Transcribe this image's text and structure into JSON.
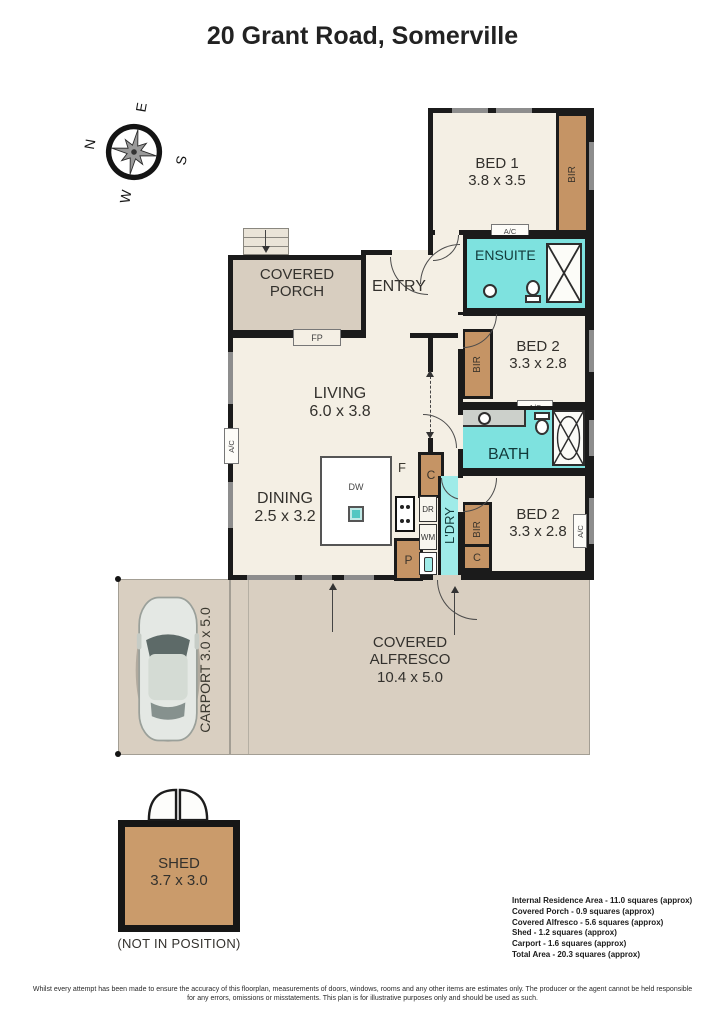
{
  "title": "20 Grant Road, Somerville",
  "compass": {
    "n": "N",
    "e": "E",
    "s": "S",
    "w": "W"
  },
  "rooms": {
    "bed1": {
      "name": "BED 1",
      "dims": "3.8 x 3.5"
    },
    "ensuite": {
      "name": "ENSUITE"
    },
    "bed2a": {
      "name": "BED 2",
      "dims": "3.3 x 2.8"
    },
    "bath": {
      "name": "BATH"
    },
    "bed2b": {
      "name": "BED 2",
      "dims": "3.3 x 2.8"
    },
    "entry": {
      "name": "ENTRY"
    },
    "living": {
      "name": "LIVING",
      "dims": "6.0 x 3.8"
    },
    "dining": {
      "name": "DINING",
      "dims": "2.5 x 3.2"
    },
    "kitchen": {
      "name": "KITCHEN",
      "dims": "2.8 x 3.2"
    },
    "laundry": {
      "name": "L'DRY"
    },
    "porch": {
      "line1": "COVERED",
      "line2": "PORCH"
    },
    "alfresco": {
      "line1": "COVERED",
      "line2": "ALFRESCO",
      "dims": "10.4 x 5.0"
    },
    "carport": {
      "name": "CARPORT 3.0 x 5.0"
    },
    "shed": {
      "name": "SHED",
      "dims": "3.7 x 3.0",
      "note": "(NOT IN POSITION)"
    }
  },
  "fixtures": {
    "bir": "BIR",
    "ac": "A/C",
    "fp": "FP",
    "dw": "DW",
    "fridge": "F",
    "cupboard": "C",
    "pantry": "P",
    "dryer": "DR",
    "washer": "WM"
  },
  "legend": [
    "Internal Residence Area - 11.0 squares (approx)",
    "Covered Porch - 0.9 squares (approx)",
    "Covered Alfresco - 5.6 squares (approx)",
    "Shed - 1.2 squares (approx)",
    "Carport - 1.6 squares (approx)",
    "Total Area - 20.3 squares (approx)"
  ],
  "disclaimer": "Whilst every attempt has been made to ensure the accuracy of this floorplan, measurements of doors, windows, rooms and any other items are estimates only. The producer or the agent cannot be held responsible for any errors, omissions or misstatements. This plan is for illustrative purposes only and should be used as such.",
  "colors": {
    "wall": "#1b1b1b",
    "floor": "#f4efe4",
    "outdoor": "#d9cfc1",
    "wet": "#7ee2df",
    "robe": "#c59465",
    "shed": "#ca9b6b",
    "window": "#8d8d8d"
  }
}
